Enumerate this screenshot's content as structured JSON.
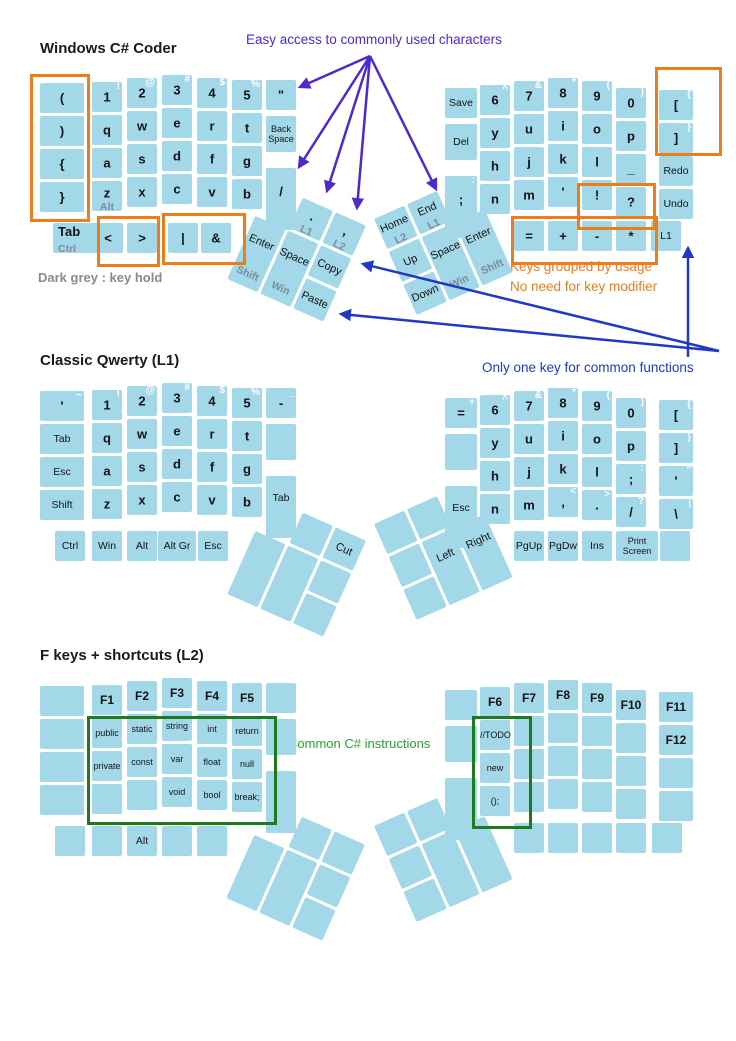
{
  "sections": [
    {
      "title": "Windows C# Coder"
    },
    {
      "title": "Classic Qwerty (L1)"
    },
    {
      "title": "F keys + shortcuts (L2)"
    }
  ],
  "annotations": {
    "easy_access": {
      "text": "Easy access to commonly used characters",
      "color": "#4f28d0"
    },
    "dark_grey": {
      "text": "Dark grey : key hold",
      "color": "#8a8a8a"
    },
    "keys_grouped": {
      "line1": "Keys grouped by usage",
      "line2": "No need for key modifier",
      "color": "#f07a1e"
    },
    "only_one_key": {
      "text": "Only one key for common functions",
      "color": "#2038c8"
    },
    "common_csharp": {
      "text": "Common C# instructions",
      "color": "#2f9e2f"
    }
  },
  "colors": {
    "key_fill": "#a2d8e8",
    "orange_box": "#ee7d18",
    "green_box": "#1d7a1d",
    "hold_label": "#7e8b96",
    "shifted_label": "#ffffff"
  },
  "keyboards": [
    {
      "name": "windows-csharp-coder",
      "base": {
        "left": 75,
        "right": 78
      },
      "left": {
        "c0": [
          "(",
          ")",
          "{",
          "}"
        ],
        "main": [
          [
            {
              "t": "1",
              "s": "!"
            },
            {
              "t": "2",
              "s": "@"
            },
            {
              "t": "3",
              "s": "#"
            },
            {
              "t": "4",
              "s": "$"
            },
            {
              "t": "5",
              "s": "%"
            }
          ],
          [
            "q",
            "w",
            "e",
            "r",
            "t"
          ],
          [
            "a",
            "s",
            "d",
            "f",
            "g"
          ],
          [
            {
              "t": "z",
              "h": "Alt"
            },
            "x",
            "c",
            "v",
            "b"
          ]
        ],
        "c6": [
          "\"",
          {
            "t": "Back Space",
            "small": true
          },
          "/"
        ],
        "bottom": [
          {
            "t": "Tab",
            "h": "Ctrl",
            "x": 53,
            "w": 48,
            "big": true
          },
          {
            "t": "<",
            "x": 93
          },
          {
            "t": ">",
            "x": 127
          },
          {
            "t": "|",
            "x": 168
          },
          {
            "t": "&",
            "x": 201
          }
        ]
      },
      "right": {
        "c0": [
          "Save",
          "Del",
          {
            "t": ";",
            "s": ":"
          }
        ],
        "main": [
          [
            {
              "t": "6",
              "s": "^"
            },
            {
              "t": "7",
              "s": "&"
            },
            {
              "t": "8",
              "s": "*"
            },
            {
              "t": "9",
              "s": "("
            },
            {
              "t": "0",
              "s": ")"
            }
          ],
          [
            "y",
            "u",
            "i",
            "o",
            "p"
          ],
          [
            "h",
            "j",
            "k",
            "l",
            "_"
          ],
          [
            "n",
            "m",
            "'",
            "!",
            "?"
          ]
        ],
        "c6": [
          {
            "t": "[",
            "s": "{"
          },
          {
            "t": "]",
            "s": "}"
          },
          "Redo",
          "Undo"
        ],
        "bottom": [
          {
            "t": "=",
            "x": 514
          },
          {
            "t": "+",
            "x": 548
          },
          {
            "t": "-",
            "x": 582
          },
          {
            "t": "*",
            "x": 616
          },
          {
            "t": "L1",
            "x": 651
          }
        ]
      },
      "lcluster": [
        {
          "t": ".",
          "h": "L1"
        },
        {
          "t": ",",
          "h": "L2"
        },
        {
          "t": "Enter",
          "h": "Shift"
        },
        {
          "t": "Space",
          "h": "Win"
        },
        {
          "t": "Copy"
        },
        {
          "t": "Paste"
        }
      ],
      "rcluster": [
        {
          "t": "Home",
          "h": "L2"
        },
        {
          "t": "End",
          "h": "L1"
        },
        {
          "t": "Up"
        },
        {
          "t": "Down"
        },
        {
          "t": "Space",
          "h": "Win"
        },
        {
          "t": "Enter",
          "h": "Shift"
        }
      ],
      "cluster": {
        "left": [
          270,
          183,
          24
        ],
        "right": [
          374,
          219,
          -24
        ]
      }
    },
    {
      "name": "classic-qwerty-l1",
      "base": {
        "left": 383,
        "right": 388
      },
      "left": {
        "c0": [
          {
            "t": "'",
            "s": "~"
          },
          "Tab",
          "Esc",
          "Shift"
        ],
        "main": [
          [
            {
              "t": "1",
              "s": "!"
            },
            {
              "t": "2",
              "s": "@"
            },
            {
              "t": "3",
              "s": "#"
            },
            {
              "t": "4",
              "s": "$"
            },
            {
              "t": "5",
              "s": "%"
            }
          ],
          [
            "q",
            "w",
            "e",
            "r",
            "t"
          ],
          [
            "a",
            "s",
            "d",
            "f",
            "g"
          ],
          [
            "z",
            "x",
            "c",
            "v",
            "b"
          ]
        ],
        "c6": [
          {
            "t": "-",
            "s": "_"
          },
          "",
          "Tab"
        ],
        "bottom": [
          {
            "t": "Ctrl",
            "x": 55
          },
          {
            "t": "Win",
            "x": 92
          },
          {
            "t": "Alt",
            "x": 127
          },
          {
            "t": "Alt Gr",
            "x": 158,
            "w": 38
          },
          {
            "t": "Esc",
            "x": 198
          }
        ]
      },
      "right": {
        "c0": [
          {
            "t": "=",
            "s": "+"
          },
          "",
          "Esc"
        ],
        "main": [
          [
            {
              "t": "6",
              "s": "^"
            },
            {
              "t": "7",
              "s": "&"
            },
            {
              "t": "8",
              "s": "*"
            },
            {
              "t": "9",
              "s": "("
            },
            {
              "t": "0",
              "s": ")"
            }
          ],
          [
            "y",
            "u",
            "i",
            "o",
            "p"
          ],
          [
            "h",
            "j",
            "k",
            "l",
            {
              "t": ";",
              "s": ":"
            }
          ],
          [
            "n",
            "m",
            {
              "t": ",",
              "s": "<"
            },
            {
              "t": ".",
              "s": ">"
            },
            {
              "t": "/",
              "s": "?"
            }
          ]
        ],
        "c6": [
          {
            "t": "[",
            "s": "{"
          },
          {
            "t": "]",
            "s": "}"
          },
          {
            "t": "'",
            "s": "\""
          },
          {
            "t": "\\",
            "s": "|"
          }
        ],
        "bottom": [
          {
            "t": "PgUp",
            "x": 514
          },
          {
            "t": "PgDw",
            "x": 548
          },
          {
            "t": "Ins",
            "x": 582
          },
          {
            "t": "Print Screen",
            "x": 616,
            "w": 42,
            "small": true
          },
          {
            "t": "",
            "x": 660
          }
        ]
      },
      "lcluster": [
        null,
        {
          "t": "Cut"
        },
        null,
        null,
        null,
        null
      ],
      "rcluster": [
        null,
        null,
        null,
        null,
        {
          "t": "Left"
        },
        {
          "t": "Right"
        }
      ],
      "cluster": {
        "left": [
          270,
          498,
          24
        ],
        "right": [
          374,
          524,
          -24
        ]
      }
    },
    {
      "name": "fkeys-shortcuts-l2",
      "base": {
        "left": 678,
        "right": 680
      },
      "left": {
        "c0": [
          "",
          "",
          "",
          ""
        ],
        "main": [
          [
            "F1",
            "F2",
            "F3",
            "F4",
            "F5"
          ],
          [
            {
              "t": "public",
              "small": true
            },
            {
              "t": "static",
              "small": true
            },
            {
              "t": "string",
              "small": true
            },
            {
              "t": "int",
              "small": true
            },
            {
              "t": "return",
              "small": true
            }
          ],
          [
            {
              "t": "private",
              "small": true
            },
            {
              "t": "const",
              "small": true
            },
            {
              "t": "var",
              "small": true
            },
            {
              "t": "float",
              "small": true
            },
            {
              "t": "null",
              "small": true
            }
          ],
          [
            "",
            "",
            {
              "t": "void",
              "small": true
            },
            {
              "t": "bool",
              "small": true
            },
            {
              "t": "break;",
              "small": true
            }
          ]
        ],
        "c6": [
          "",
          "",
          ""
        ],
        "bottom": [
          {
            "t": "",
            "x": 55
          },
          {
            "t": "",
            "x": 92
          },
          {
            "t": "Alt",
            "x": 127
          },
          {
            "t": "",
            "x": 162
          },
          {
            "t": "",
            "x": 197
          }
        ]
      },
      "right": {
        "c0": [
          "",
          "",
          ""
        ],
        "main": [
          [
            "F6",
            "F7",
            "F8",
            "F9",
            "F10"
          ],
          [
            {
              "t": "//TODO",
              "small": true
            },
            "",
            "",
            "",
            ""
          ],
          [
            {
              "t": "new",
              "small": true
            },
            "",
            "",
            "",
            ""
          ],
          [
            {
              "t": "();",
              "small": true
            },
            "",
            "",
            "",
            ""
          ]
        ],
        "c6": [
          "F11",
          "F12",
          "",
          ""
        ],
        "bottom": [
          {
            "t": "",
            "x": 514
          },
          {
            "t": "",
            "x": 548
          },
          {
            "t": "",
            "x": 582
          },
          {
            "t": "",
            "x": 616
          },
          {
            "t": "",
            "x": 652
          }
        ]
      },
      "lcluster": [
        null,
        null,
        null,
        null,
        null,
        null
      ],
      "rcluster": [
        null,
        null,
        null,
        null,
        null,
        null
      ],
      "cluster": {
        "left": [
          269,
          802,
          24
        ],
        "right": [
          374,
          826,
          -24
        ]
      }
    }
  ],
  "overlays": {
    "boxes": [
      {
        "x": 30,
        "y": 74,
        "w": 54,
        "h": 142,
        "color": "orange"
      },
      {
        "x": 97,
        "y": 216,
        "w": 57,
        "h": 45,
        "color": "orange"
      },
      {
        "x": 162,
        "y": 213,
        "w": 78,
        "h": 46,
        "color": "orange"
      },
      {
        "x": 655,
        "y": 67,
        "w": 61,
        "h": 83,
        "color": "orange"
      },
      {
        "x": 577,
        "y": 183,
        "w": 73,
        "h": 41,
        "color": "orange"
      },
      {
        "x": 511,
        "y": 216,
        "w": 141,
        "h": 43,
        "color": "orange"
      },
      {
        "x": 87,
        "y": 716,
        "w": 184,
        "h": 103,
        "color": "green"
      },
      {
        "x": 472,
        "y": 716,
        "w": 54,
        "h": 107,
        "color": "green"
      }
    ],
    "arrows": [
      {
        "x1": 370,
        "y1": 56,
        "x2": 300,
        "y2": 87,
        "c": "purple"
      },
      {
        "x1": 370,
        "y1": 56,
        "x2": 299,
        "y2": 167,
        "c": "purple"
      },
      {
        "x1": 370,
        "y1": 56,
        "x2": 327,
        "y2": 191,
        "c": "purple"
      },
      {
        "x1": 370,
        "y1": 56,
        "x2": 357,
        "y2": 208,
        "c": "purple"
      },
      {
        "x1": 370,
        "y1": 56,
        "x2": 436,
        "y2": 189,
        "c": "purple"
      },
      {
        "x1": 688,
        "y1": 357,
        "x2": 688,
        "y2": 248,
        "c": "blue"
      },
      {
        "x1": 719,
        "y1": 351,
        "x2": 363,
        "y2": 264,
        "c": "blue"
      },
      {
        "x1": 719,
        "y1": 351,
        "x2": 341,
        "y2": 314,
        "c": "blue"
      }
    ]
  }
}
